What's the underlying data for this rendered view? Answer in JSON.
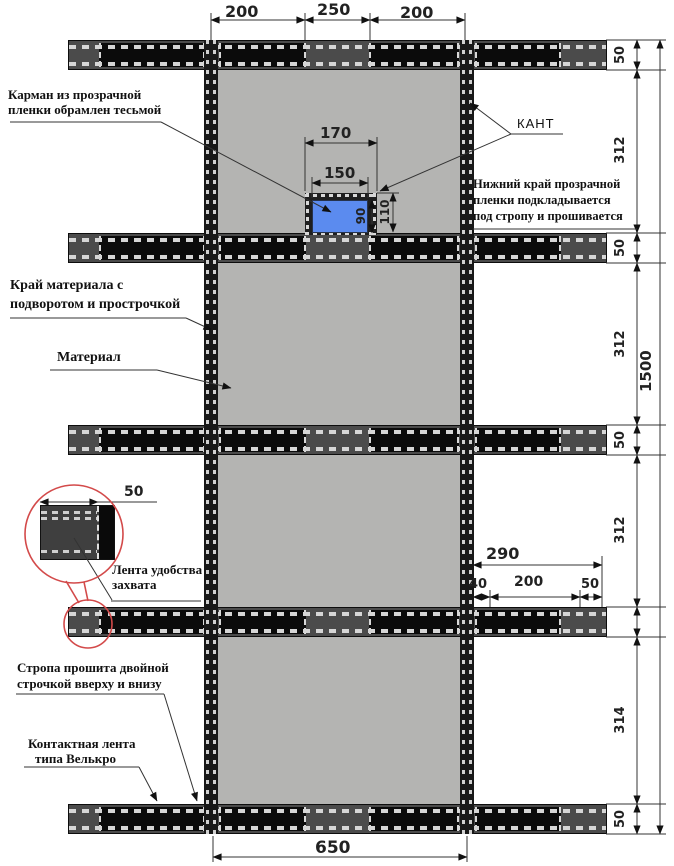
{
  "labels": {
    "pocket_l1": "Карман из прозрачной",
    "pocket_l2": "пленки обрамлен тесьмой",
    "kant": "КАНТ",
    "film_l1": "Нижний край прозрачной",
    "film_l2": "пленки подкладывается",
    "film_l3": "под стропу и прошивается",
    "edge_l1": "Край материала с",
    "edge_l2": "подворотом и прострочкой",
    "material": "Материал",
    "grip_l1": "Лента удобства",
    "grip_l2": "захвата",
    "sewn_l1": "Стропа прошита двойной",
    "sewn_l2": "строчкой вверху и внизу",
    "velcro_l1": "Контактная лента",
    "velcro_l2": "типа Велькро"
  },
  "dims": {
    "top_left": "200",
    "top_center": "250",
    "top_right": "200",
    "pocket_outer_width": "170",
    "pocket_inner_width": "150",
    "pocket_height": "110",
    "pocket_inner_height": "90",
    "strap_width": "50",
    "section_1": "312",
    "section_2": "312",
    "section_3": "312",
    "section_4": "314",
    "total_height": "1500",
    "material_width": "650",
    "grip_total": "290",
    "grip_offset": "40",
    "grip_length": "200",
    "grip_margin": "50",
    "detail_width": "50"
  },
  "colors": {
    "material": "#b4b4b2",
    "webbing": "#0b0b0b",
    "grip_tape": "#4b4b4b",
    "stitch": "#d6d6d6",
    "pocket_film": "#5b8bef",
    "detail_callout": "#d34a4a"
  }
}
